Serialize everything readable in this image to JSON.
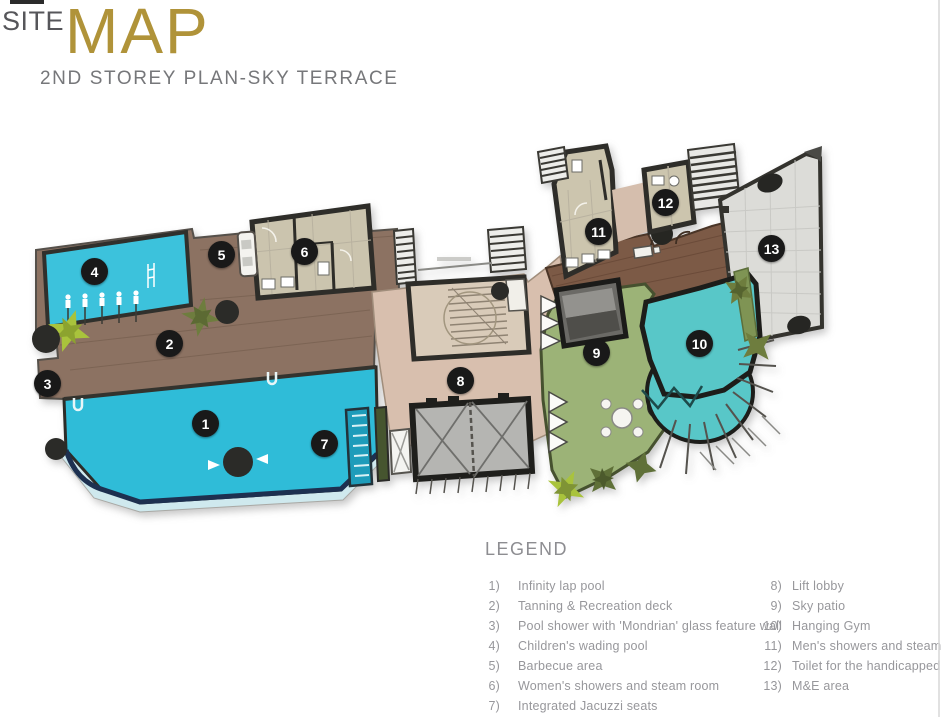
{
  "header": {
    "title_prefix": "SITE",
    "title_main": "MAP",
    "subtitle": "2ND STOREY PLAN-SKY TERRACE"
  },
  "legend": {
    "heading": "LEGEND",
    "columns": [
      {
        "items": [
          {
            "num": "1)",
            "label": "Infinity lap pool"
          },
          {
            "num": "2)",
            "label": "Tanning & Recreation deck"
          },
          {
            "num": "3)",
            "label": "Pool shower with 'Mondrian' glass feature wall"
          },
          {
            "num": "4)",
            "label": "Children's wading pool"
          },
          {
            "num": "5)",
            "label": "Barbecue area"
          },
          {
            "num": "6)",
            "label": "Women's showers and steam room"
          },
          {
            "num": "7)",
            "label": "Integrated Jacuzzi seats"
          }
        ]
      },
      {
        "items": [
          {
            "num": "8)",
            "label": "Lift lobby"
          },
          {
            "num": "9)",
            "label": "Sky patio"
          },
          {
            "num": "10)",
            "label": "Hanging Gym"
          },
          {
            "num": "11)",
            "label": "Men's showers and steam room"
          },
          {
            "num": "12)",
            "label": "Toilet for the handicapped"
          },
          {
            "num": "13)",
            "label": "M&E area"
          }
        ]
      }
    ]
  },
  "map": {
    "markers": [
      {
        "num": "1",
        "x": 206,
        "y": 424,
        "label": "Infinity lap pool"
      },
      {
        "num": "2",
        "x": 170,
        "y": 344,
        "label": "Tanning & Recreation deck"
      },
      {
        "num": "3",
        "x": 48,
        "y": 384,
        "label": "Pool shower with 'Mondrian' glass feature wall"
      },
      {
        "num": "4",
        "x": 95,
        "y": 272,
        "label": "Children's wading pool"
      },
      {
        "num": "5",
        "x": 222,
        "y": 255,
        "label": "Barbecue area"
      },
      {
        "num": "6",
        "x": 305,
        "y": 252,
        "label": "Women's showers and steam room"
      },
      {
        "num": "7",
        "x": 325,
        "y": 444,
        "label": "Integrated Jacuzzi seats"
      },
      {
        "num": "8",
        "x": 461,
        "y": 381,
        "label": "Lift lobby"
      },
      {
        "num": "9",
        "x": 597,
        "y": 353,
        "label": "Sky patio"
      },
      {
        "num": "10",
        "x": 700,
        "y": 344,
        "label": "Hanging Gym"
      },
      {
        "num": "11",
        "x": 599,
        "y": 232,
        "label": "Men's showers and steam room"
      },
      {
        "num": "12",
        "x": 666,
        "y": 203,
        "label": "Toilet for the handicapped"
      },
      {
        "num": "13",
        "x": 772,
        "y": 249,
        "label": "M&E area"
      }
    ],
    "colors": {
      "pool": "#2fbcd8",
      "kids_pool": "#3cc2dc",
      "deck": "#8c7262",
      "dark_deck": "#7c5a46",
      "lawn": "#9cb377",
      "gym": "#58c7c8",
      "lobby": "#d8bfae",
      "room_tile": "#ccc5ae",
      "mne": "#dcdcd8",
      "wall": "#2e2d29",
      "marker_bg": "#191919",
      "title_gold": "#b09339"
    }
  }
}
